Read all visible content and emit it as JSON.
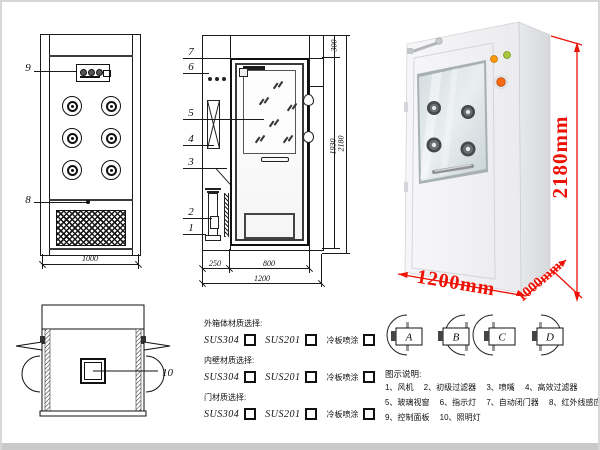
{
  "front_view": {
    "callout_9": "9",
    "callout_8": "8",
    "dim_width": "1000"
  },
  "section_view": {
    "callouts": [
      "7",
      "6",
      "5",
      "4",
      "3",
      "2",
      "1"
    ],
    "dim_plenum": "300",
    "dim_door_height": "1930",
    "dim_total_height": "2180",
    "dim_left_depth": "250",
    "dim_door_width": "800",
    "dim_total_width": "1200"
  },
  "photo": {
    "dim_height": "2180mm",
    "dim_width": "1200mm",
    "dim_depth": "1000mm"
  },
  "top_view": {
    "callout_10": "10"
  },
  "materials": {
    "groups": [
      {
        "label": "外箱体材质选择:",
        "options": [
          "SUS304",
          "SUS201",
          "冷板喷涂"
        ]
      },
      {
        "label": "内壁材质选择:",
        "options": [
          "SUS304",
          "SUS201",
          "冷板喷涂"
        ]
      },
      {
        "label": "门材质选择:",
        "options": [
          "SUS304",
          "SUS201",
          "冷板喷涂"
        ]
      }
    ]
  },
  "door_configs": {
    "labels": [
      "A",
      "B",
      "C",
      "D"
    ]
  },
  "legend": {
    "title": "图示说明:",
    "items": [
      {
        "no": "1",
        "name": "风机"
      },
      {
        "no": "2",
        "name": "初级过滤器"
      },
      {
        "no": "3",
        "name": "喷嘴"
      },
      {
        "no": "4",
        "name": "高效过滤器"
      },
      {
        "no": "5",
        "name": "玻璃视窗"
      },
      {
        "no": "6",
        "name": "指示灯"
      },
      {
        "no": "7",
        "name": "自动闭门器"
      },
      {
        "no": "8",
        "name": "红外线感应器"
      },
      {
        "no": "9",
        "name": "控制面板"
      },
      {
        "no": "10",
        "name": "照明灯"
      }
    ],
    "rows": [
      [
        0,
        1,
        2,
        3
      ],
      [
        4,
        5,
        6,
        7
      ],
      [
        8,
        9
      ]
    ]
  },
  "colors": {
    "dimension_red": "#ee1105",
    "drawing_line": "#1a1a1a"
  }
}
